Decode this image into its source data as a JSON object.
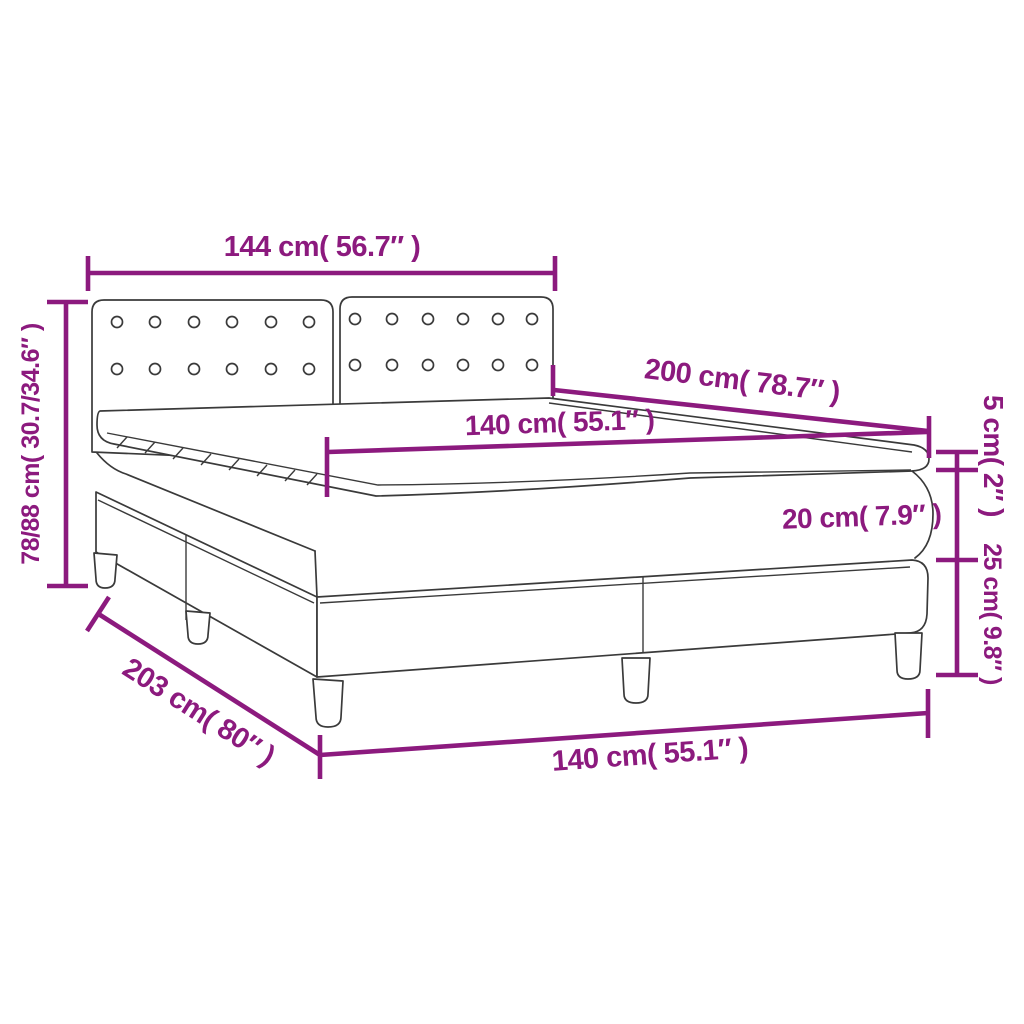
{
  "colors": {
    "dim": "#8c1a7e",
    "line": "#3a3a3a",
    "bg": "#ffffff"
  },
  "dimensions": {
    "headboard_width": "144 cm( 56.7″ )",
    "overall_height": "78/88 cm( 30.7/34.6″ )",
    "bed_length": "200 cm( 78.7″ )",
    "mattress_width_top": "140 cm( 55.1″ )",
    "topper_height": "5 cm( 2″ )",
    "mattress_height": "20 cm( 7.9″ )",
    "box_height": "25 cm( 9.8″ )",
    "frame_length": "203 cm( 80″ )",
    "mattress_width_bottom": "140 cm( 55.1″ )"
  }
}
